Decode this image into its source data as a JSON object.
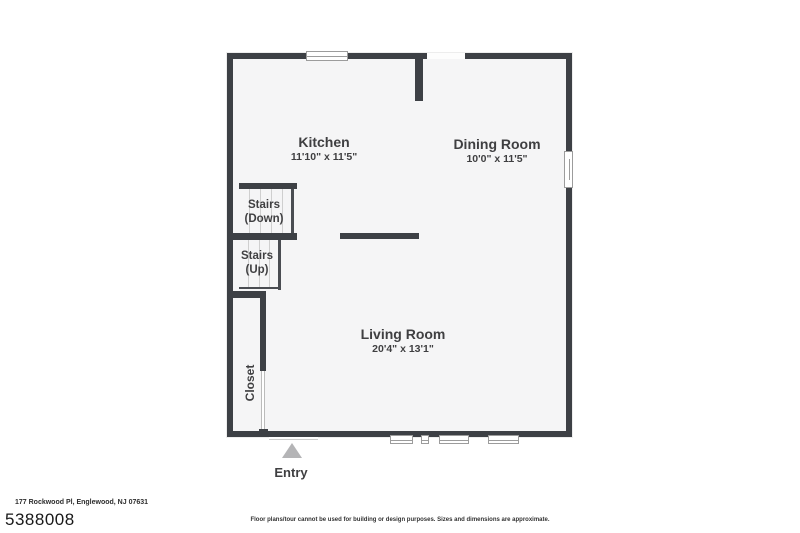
{
  "plan": {
    "rooms": [
      {
        "name": "Kitchen",
        "dims": "11'10\" x 11'5\""
      },
      {
        "name": "Dining Room",
        "dims": "10'0\" x 11'5\""
      },
      {
        "name": "Living Room",
        "dims": "20'4\" x 13'1\""
      }
    ],
    "stairs_down": {
      "line1": "Stairs",
      "line2": "(Down)"
    },
    "stairs_up": {
      "line1": "Stairs",
      "line2": "(Up)"
    },
    "closet_label": "Closet",
    "entry_label": "Entry"
  },
  "footer": {
    "address": "177 Rockwood Pl, Englewood, NJ 07631",
    "listing_id": "5388008",
    "disclaimer": "Floor plans/tour cannot be used for building or design purposes. Sizes and dimensions are approximate."
  },
  "colors": {
    "wall": "#3d4045",
    "floor": "#f5f5f6",
    "label": "#3f3f41",
    "tread": "#cfcfcf",
    "window_frame": "#9c9c9c",
    "entry_arrow": "#b4b4b6"
  }
}
